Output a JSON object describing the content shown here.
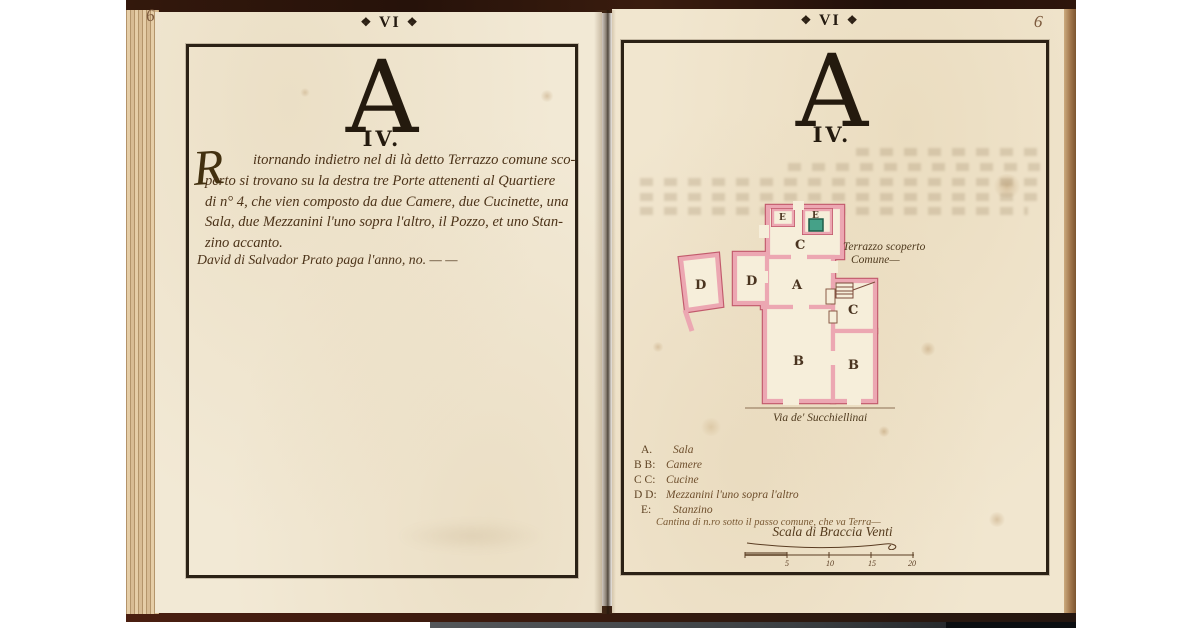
{
  "left_page": {
    "folio": "6",
    "ornament": "❖",
    "header": "VI",
    "letter": "A",
    "numeral": "IV.",
    "initial": "R",
    "lines": [
      "itornando indietro nel di là detto Terrazzo comune sco-",
      "perto si trovano su la destra tre Porte attenenti al Quartiere",
      "di n° 4, che vien composto da due Camere, due Cucinette, una",
      "Sala, due Mezzanini l'uno sopra l'altro, il Pozzo, et uno Stan-",
      "zino accanto."
    ],
    "payer_line": "David di Salvador Prato paga l'anno, no. — —"
  },
  "right_page": {
    "folio": "6",
    "ornament": "❖",
    "header": "VI",
    "letter": "A",
    "numeral": "IV.",
    "plan": {
      "annotation_line1": "Terrazzo scoperto",
      "annotation_line2": "Comune—",
      "street": "Via de' Succhiellinai",
      "rooms": {
        "a": "A",
        "b1": "B",
        "b2": "B",
        "c1": "C",
        "c2": "C",
        "d1": "D",
        "d2": "D",
        "e1": "E",
        "e2": "E"
      },
      "colors": {
        "wall_fill": "#eca7b2",
        "wall_line": "#c25a6c",
        "well_fill": "#45a188",
        "ink": "#4a3420",
        "room_fill": "#f6eeda"
      }
    },
    "legend": {
      "items": [
        {
          "key": "A.",
          "value": "Sala"
        },
        {
          "key": "B B:",
          "value": "Camere"
        },
        {
          "key": "C C:",
          "value": "Cucine"
        },
        {
          "key": "D D:",
          "value": "Mezzanini l'uno sopra l'altro"
        },
        {
          "key": "E:",
          "value": "Stanzino"
        }
      ],
      "note": "Cantina di n.ro sotto il passo comune, che va Terra—"
    },
    "scale_bar": {
      "label": "Scala di Braccia Venti",
      "ticks": [
        "5",
        "10",
        "15",
        "20"
      ]
    }
  }
}
